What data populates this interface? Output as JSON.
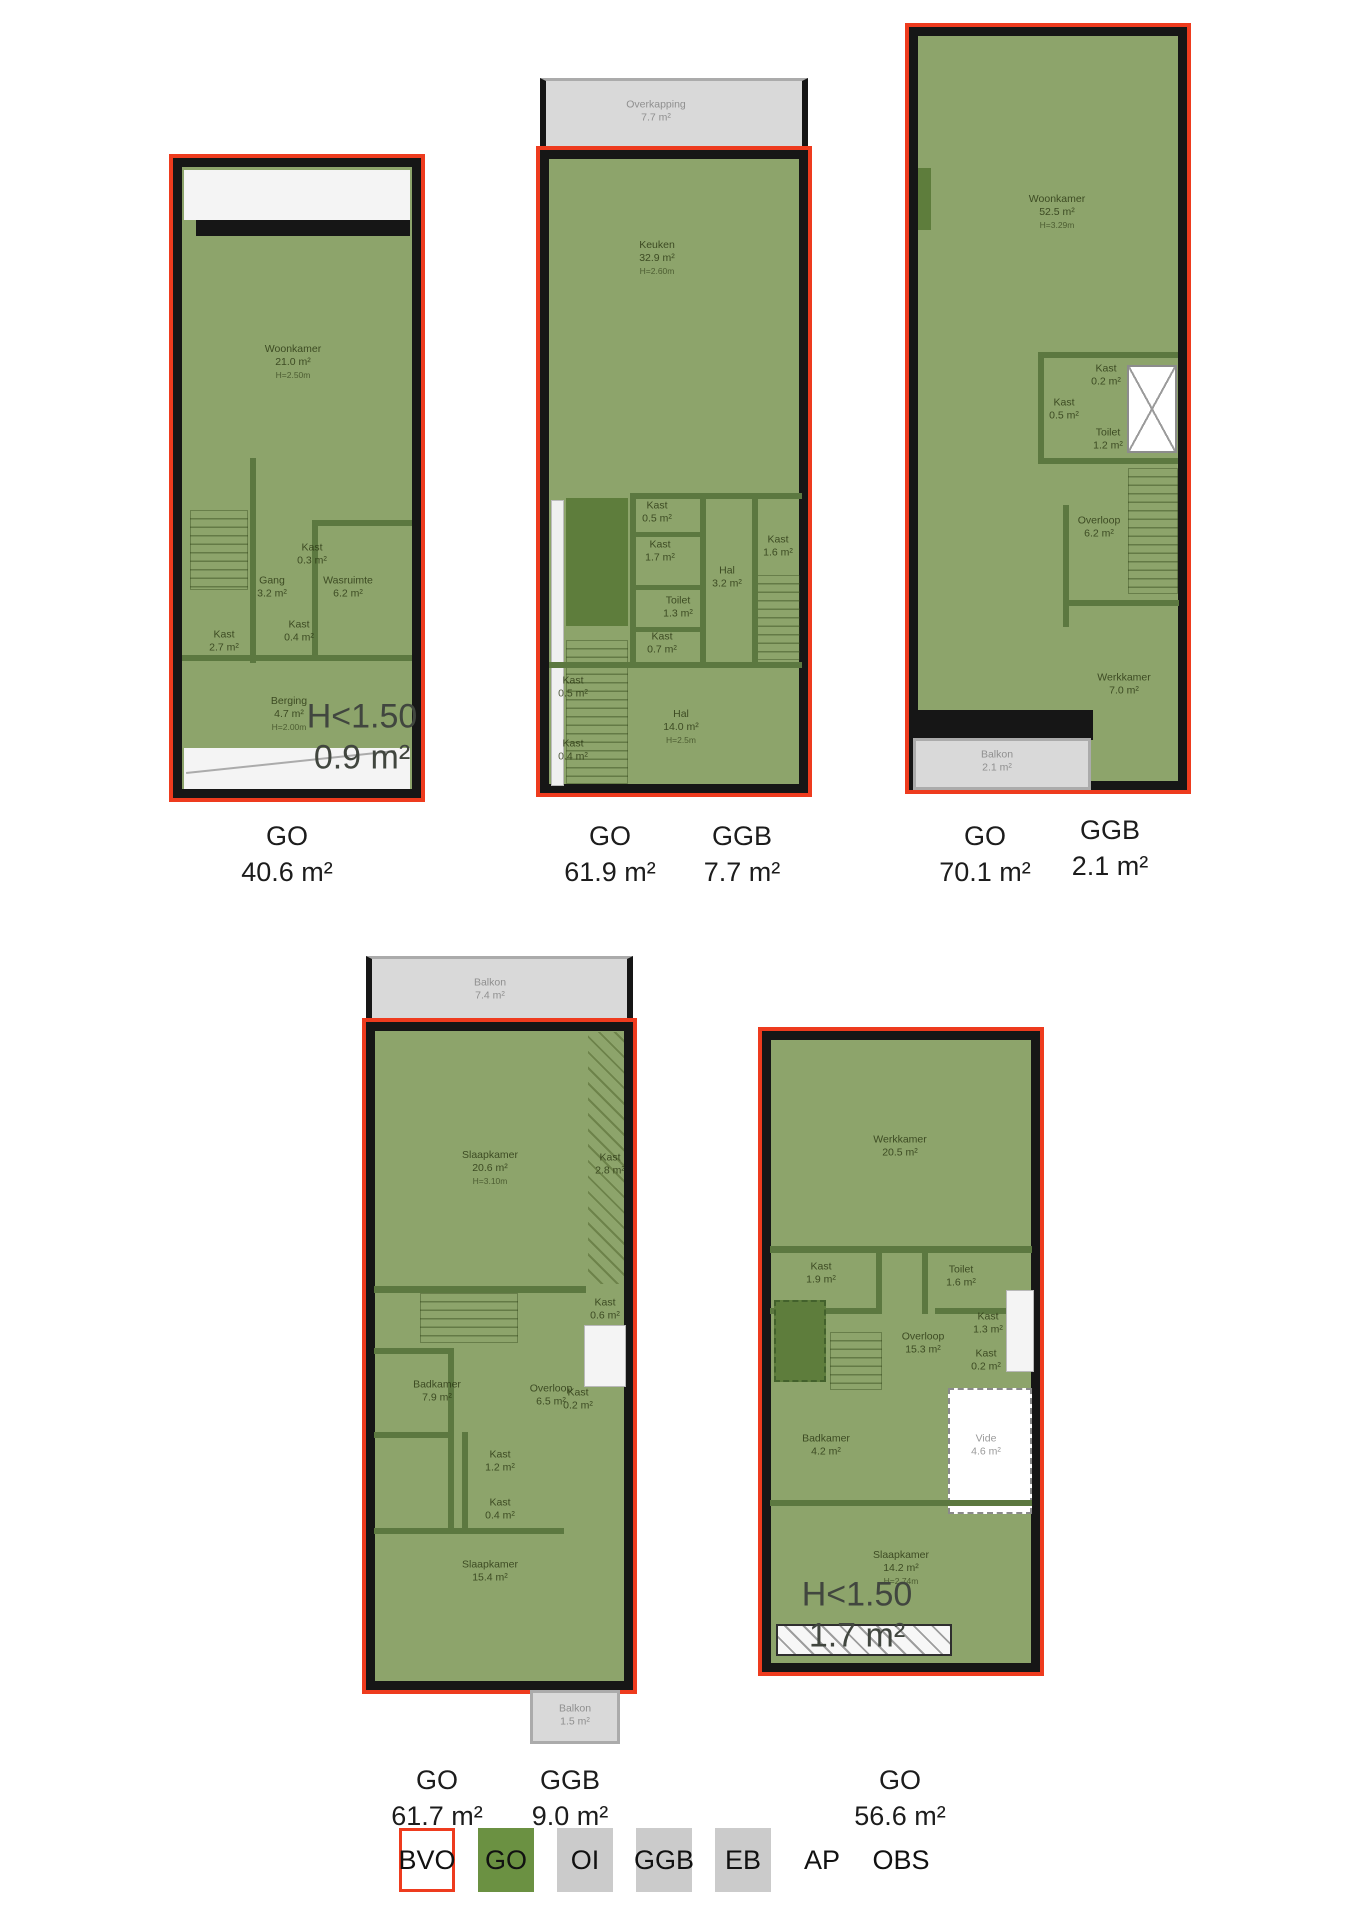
{
  "palette": {
    "plan_green": "#8da46b",
    "legend_green": "#6b9142",
    "outline_red": "#ee3b1e",
    "wall_black": "#161616",
    "annex_grey": "#d9d9d9"
  },
  "plans": [
    {
      "name": "floorplan-1",
      "rooms": [
        {
          "name": "Woonkamer",
          "area": "21.0 m²",
          "note": "H=2.50m"
        },
        {
          "name": "Kast",
          "area": "0.3 m²"
        },
        {
          "name": "Gang",
          "area": "3.2 m²"
        },
        {
          "name": "Wasruimte",
          "area": "6.2 m²"
        },
        {
          "name": "Kast",
          "area": "2.7 m²"
        },
        {
          "name": "Kast",
          "area": "0.4 m²"
        },
        {
          "name": "Berging",
          "area": "4.7 m²",
          "note": "H=2.00m"
        }
      ],
      "lowheight": {
        "label": "H<1.50",
        "area": "0.9 m²"
      },
      "metrics": [
        {
          "label": "GO",
          "value": "40.6 m²"
        }
      ]
    },
    {
      "name": "floorplan-2",
      "annexes": [
        {
          "name": "Overkapping",
          "area": "7.7 m²"
        }
      ],
      "rooms": [
        {
          "name": "Keuken",
          "area": "32.9 m²",
          "note": "H=2.60m"
        },
        {
          "name": "Kast",
          "area": "0.5 m²"
        },
        {
          "name": "Kast",
          "area": "1.7 m²"
        },
        {
          "name": "Toilet",
          "area": "1.3 m²"
        },
        {
          "name": "Kast",
          "area": "0.7 m²"
        },
        {
          "name": "Hal",
          "area": "3.2 m²"
        },
        {
          "name": "Kast",
          "area": "1.6 m²"
        },
        {
          "name": "Hal",
          "area": "14.0 m²",
          "note": "H=2.5m"
        },
        {
          "name": "Kast",
          "area": "0.5 m²"
        },
        {
          "name": "Kast",
          "area": "0.4 m²"
        }
      ],
      "metrics": [
        {
          "label": "GO",
          "value": "61.9 m²"
        },
        {
          "label": "GGB",
          "value": "7.7 m²"
        }
      ]
    },
    {
      "name": "floorplan-3",
      "annexes": [
        {
          "name": "Balkon",
          "area": "2.1 m²"
        }
      ],
      "rooms": [
        {
          "name": "Woonkamer",
          "area": "52.5 m²",
          "note": "H=3.29m"
        },
        {
          "name": "Kast",
          "area": "0.2 m²"
        },
        {
          "name": "Kast",
          "area": "0.5 m²"
        },
        {
          "name": "Toilet",
          "area": "1.2 m²"
        },
        {
          "name": "Overloop",
          "area": "6.2 m²"
        },
        {
          "name": "Werkkamer",
          "area": "7.0 m²"
        }
      ],
      "metrics": [
        {
          "label": "GO",
          "value": "70.1 m²"
        },
        {
          "label": "GGB",
          "value": "2.1 m²"
        }
      ]
    },
    {
      "name": "floorplan-4",
      "annexes": [
        {
          "name": "Balkon",
          "area": "7.4 m²"
        },
        {
          "name": "Balkon",
          "area": "1.5 m²"
        }
      ],
      "rooms": [
        {
          "name": "Slaapkamer",
          "area": "20.6 m²",
          "note": "H=3.10m"
        },
        {
          "name": "Kast",
          "area": "2.8 m²"
        },
        {
          "name": "Kast",
          "area": "0.6 m²"
        },
        {
          "name": "Kast",
          "area": "0.2 m²"
        },
        {
          "name": "Badkamer",
          "area": "7.9 m²"
        },
        {
          "name": "Overloop",
          "area": "6.5 m²"
        },
        {
          "name": "Kast",
          "area": "1.2 m²"
        },
        {
          "name": "Kast",
          "area": "0.4 m²"
        },
        {
          "name": "Slaapkamer",
          "area": "15.4 m²"
        }
      ],
      "metrics": [
        {
          "label": "GO",
          "value": "61.7 m²"
        },
        {
          "label": "GGB",
          "value": "9.0 m²"
        }
      ]
    },
    {
      "name": "floorplan-5",
      "rooms": [
        {
          "name": "Werkkamer",
          "area": "20.5 m²"
        },
        {
          "name": "Kast",
          "area": "1.9 m²"
        },
        {
          "name": "Toilet",
          "area": "1.6 m²"
        },
        {
          "name": "Overloop",
          "area": "15.3 m²"
        },
        {
          "name": "Kast",
          "area": "1.3 m²"
        },
        {
          "name": "Kast",
          "area": "0.2 m²"
        },
        {
          "name": "Badkamer",
          "area": "4.2 m²"
        },
        {
          "name": "Vide",
          "area": "4.6 m²"
        },
        {
          "name": "Slaapkamer",
          "area": "14.2 m²",
          "note": "H=2.74m"
        }
      ],
      "lowheight": {
        "label": "H<1.50",
        "area": "1.7 m²"
      },
      "metrics": [
        {
          "label": "GO",
          "value": "56.6 m²"
        }
      ]
    }
  ],
  "legend": [
    {
      "label": "BVO"
    },
    {
      "label": "GO"
    },
    {
      "label": "OI"
    },
    {
      "label": "GGB"
    },
    {
      "label": "EB"
    },
    {
      "label": "AP"
    },
    {
      "label": "OBS"
    }
  ]
}
